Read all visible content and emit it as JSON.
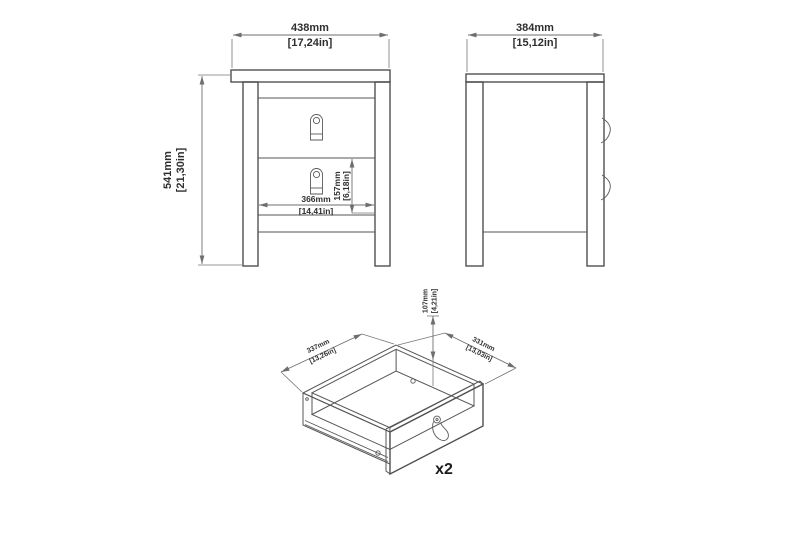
{
  "drawing_title": "furniture-dimension-drawing",
  "background": "#ffffff",
  "colors": {
    "furniture_line": "#4f4f4f",
    "dimension_line": "#6e6e6e",
    "text": "#2e2e2e"
  },
  "front_view": {
    "width": {
      "mm": "438mm",
      "inches": "[17,24in]"
    },
    "height": {
      "mm": "541mm",
      "inches": "[21,30in]"
    },
    "drawer_width": {
      "mm": "366mm",
      "inches": "[14,41in]"
    },
    "drawer_front_height": {
      "mm": "157mm",
      "inches": "[6,18in]"
    }
  },
  "side_view": {
    "depth": {
      "mm": "384mm",
      "inches": "[15,12in]"
    }
  },
  "drawer_detail_view": {
    "depth": {
      "mm": "337mm",
      "inches": "[13,26in]"
    },
    "width": {
      "mm": "331mm",
      "inches": "[13,03in]"
    },
    "height": {
      "mm": "107mm",
      "inches": "[4,21in]"
    },
    "quantity": "x2"
  }
}
